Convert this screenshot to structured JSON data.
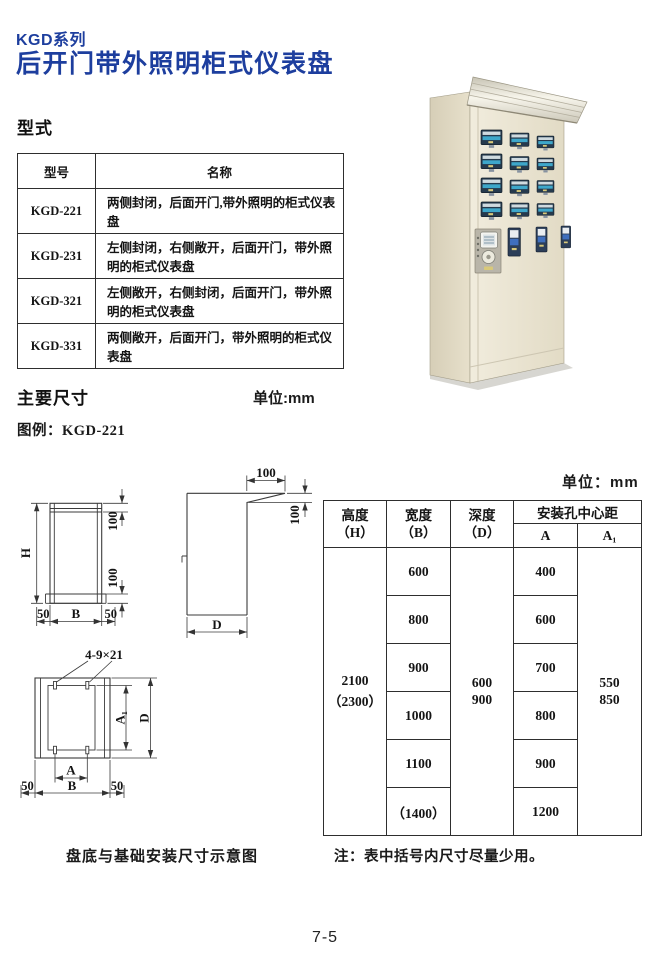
{
  "page": {
    "series_title": "KGD系列",
    "main_title": "后开门带外照明柜式仪表盘",
    "page_number": "7-5",
    "accent_color": "#1d3e9e"
  },
  "type_section": {
    "heading": "型式",
    "table": {
      "headers": {
        "model": "型号",
        "name": "名称"
      },
      "rows": [
        {
          "model": "KGD-221",
          "name": "两侧封闭，后面开门,带外照明的柜式仪表盘"
        },
        {
          "model": "KGD-231",
          "name": "左侧封闭，右侧敞开，后面开门，带外照明的柜式仪表盘"
        },
        {
          "model": "KGD-321",
          "name": "左侧敞开，右侧封闭，后面开门，带外照明的柜式仪表盘"
        },
        {
          "model": "KGD-331",
          "name": "两侧敞开，后面开门，带外照明的柜式仪表盘"
        }
      ]
    }
  },
  "dims_section": {
    "heading": "主要尺寸",
    "unit_inline": "单位:mm",
    "legend": "图例：KGD-221",
    "drawing_caption": "盘底与基础安装尺寸示意图",
    "note": "注：表中括号内尺寸尽量少用。",
    "labels": {
      "H": "H",
      "B": "B",
      "D": "D",
      "A": "A",
      "A1": "A₁",
      "d100": "100",
      "d50": "50",
      "holes": "4-9×21"
    },
    "table": {
      "unit": "单位：mm",
      "headers": {
        "height_l1": "高度",
        "height_l2": "（H）",
        "width_l1": "宽度",
        "width_l2": "（B）",
        "depth_l1": "深度",
        "depth_l2": "（D）",
        "span": "安装孔中心距",
        "a": "A",
        "a1": "A₁"
      },
      "height_values": [
        "2100",
        "（2300）"
      ],
      "width_values": [
        "600",
        "800",
        "900",
        "1000",
        "1100",
        "（1400）"
      ],
      "depth_values": [
        "600",
        "900"
      ],
      "a_values": [
        "400",
        "600",
        "700",
        "800",
        "900",
        "1200"
      ],
      "a1_values": [
        "550",
        "850"
      ]
    }
  }
}
